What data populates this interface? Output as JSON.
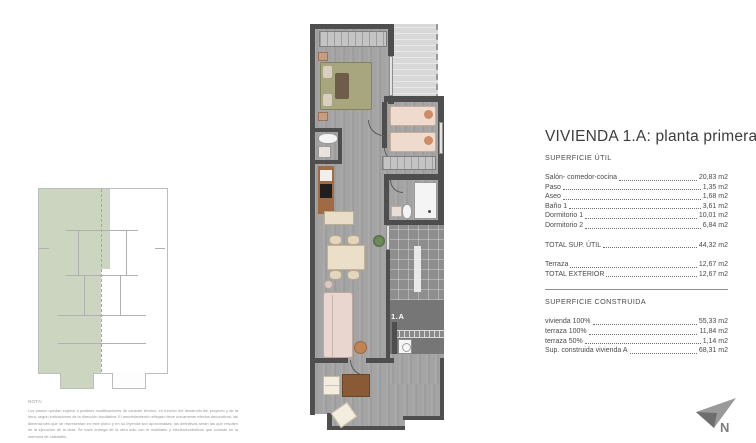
{
  "document": {
    "title": "VIVIENDA 1.A: planta primera",
    "plan_unit_label": "1.A",
    "compass_label": "N"
  },
  "superficie_util": {
    "heading": "SUPERFICIE ÚTIL",
    "rows": [
      {
        "label": "Salón- comedor-cocina",
        "value": "20,83 m2"
      },
      {
        "label": "Paso",
        "value": "1,35 m2"
      },
      {
        "label": "Aseo",
        "value": "1,68 m2"
      },
      {
        "label": "Baño 1",
        "value": "3,61 m2"
      },
      {
        "label": "Dormitorio 1",
        "value": "10,01 m2"
      },
      {
        "label": "Dormitorio 2",
        "value": "6,84 m2"
      }
    ],
    "total": {
      "label": "TOTAL SUP. ÚTIL",
      "value": "44,32 m2"
    },
    "exterior_rows": [
      {
        "label": "Terraza",
        "value": "12,67 m2"
      },
      {
        "label": "TOTAL EXTERIOR",
        "value": "12,67 m2"
      }
    ]
  },
  "superficie_construida": {
    "heading": "SUPERFICIE CONSTRUIDA",
    "rows": [
      {
        "label": "vivienda 100%",
        "value": "55,33 m2"
      },
      {
        "label": "terraza 100%",
        "value": "11,84 m2"
      },
      {
        "label": "terraza 50%",
        "value": "1,14 m2"
      },
      {
        "label": "Sup. construida vivienda A",
        "value": "68,31 m2"
      }
    ]
  },
  "note": {
    "heading": "NOTA:",
    "body": "Los planos quedan sujetos a posibles modificaciones de carácter técnico, en función del desarrollo del proyecto y de la obra, según indicaciones de la dirección facultativa. El amueblamiento reflejado tiene únicamente efectos decorativos; las dimensiones que se representan en este plano y en su leyenda son aproximadas; las definitivas serán las que resulten de la ejecución de la obra. Se hace entrega de la obra sólo con el mobiliario y electrodomésticos que constan en la memoria de calidades."
  },
  "colors": {
    "wall": "#4e4e4e",
    "floor": "#a4a4a4",
    "terrace_light": "#d8d8d8",
    "terrace_tiles": "#8e8e8e",
    "key_plan_highlight": "#ccd5c0",
    "text": "#4a4a4a"
  }
}
